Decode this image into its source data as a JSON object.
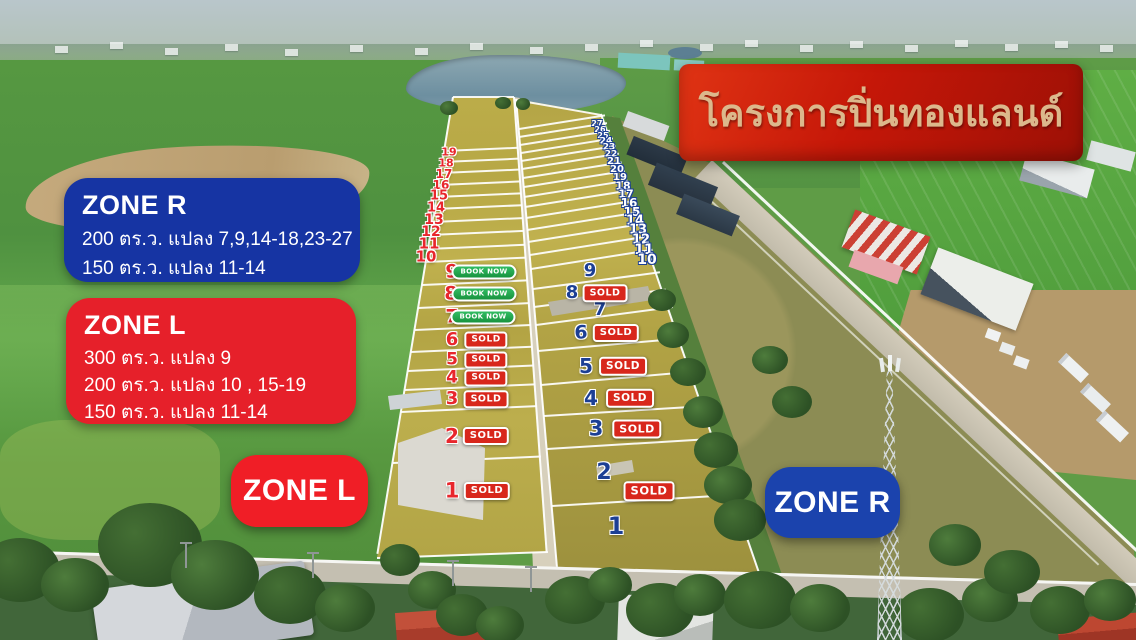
{
  "banner": {
    "title": "โครงการปิ่นทองแลนด์"
  },
  "info_boxes": {
    "zone_r": {
      "title": "ZONE R",
      "lines": [
        "200 ตร.ว. แปลง 7,9,14-18,23-27",
        "150 ตร.ว.  แปลง 11-14"
      ]
    },
    "zone_l": {
      "title": "ZONE L",
      "lines": [
        "300 ตร.ว. แปลง 9",
        "200 ตร.ว. แปลง 10 , 15-19",
        "150 ตร.ว.  แปลง 11-14"
      ]
    }
  },
  "buttons": {
    "zone_l": "ZONE L",
    "zone_r": "ZONE R"
  },
  "badges": {
    "sold": "SOLD",
    "book_now": "BOOK NOW"
  },
  "colors": {
    "banner_red": "#c21a0c",
    "banner_gold_text": "#dcb88c",
    "zone_blue": "#1634a3",
    "zone_red": "#e8212b",
    "sold_red": "#d8271c",
    "book_green": "#1f9e47",
    "num_red": "#e8262c",
    "num_navy": "#1c3f94"
  },
  "zone_l_strip": {
    "edge_numbers": [
      {
        "n": "19",
        "x": 449,
        "y": 152,
        "s": 11
      },
      {
        "n": "18",
        "x": 446,
        "y": 163,
        "s": 11
      },
      {
        "n": "17",
        "x": 444,
        "y": 174,
        "s": 12
      },
      {
        "n": "16",
        "x": 441,
        "y": 185,
        "s": 12
      },
      {
        "n": "15",
        "x": 439,
        "y": 196,
        "s": 13
      },
      {
        "n": "14",
        "x": 436,
        "y": 208,
        "s": 13
      },
      {
        "n": "13",
        "x": 434,
        "y": 220,
        "s": 14
      },
      {
        "n": "12",
        "x": 431,
        "y": 232,
        "s": 14
      },
      {
        "n": "11",
        "x": 429,
        "y": 244,
        "s": 15
      },
      {
        "n": "10",
        "x": 426,
        "y": 257,
        "s": 15
      }
    ],
    "plots": [
      {
        "n": "9",
        "x": 452,
        "y": 272,
        "s": 19,
        "badge": "book",
        "bx": 484,
        "bs": 7
      },
      {
        "n": "8",
        "x": 451,
        "y": 294,
        "s": 19,
        "badge": "book",
        "bx": 484,
        "bs": 7
      },
      {
        "n": "7",
        "x": 452,
        "y": 317,
        "s": 19,
        "badge": "book",
        "bx": 483,
        "bs": 7
      },
      {
        "n": "6",
        "x": 452,
        "y": 340,
        "s": 18,
        "badge": "sold",
        "bx": 486,
        "bs": 9
      },
      {
        "n": "5",
        "x": 452,
        "y": 360,
        "s": 17,
        "badge": "sold",
        "bx": 486,
        "bs": 9
      },
      {
        "n": "4",
        "x": 452,
        "y": 378,
        "s": 17,
        "badge": "sold",
        "bx": 486,
        "bs": 9
      },
      {
        "n": "3",
        "x": 452,
        "y": 399,
        "s": 18,
        "badge": "sold",
        "bx": 486,
        "bs": 9.5
      },
      {
        "n": "2",
        "x": 452,
        "y": 436,
        "s": 20,
        "badge": "sold",
        "bx": 486,
        "bs": 10
      },
      {
        "n": "1",
        "x": 452,
        "y": 491,
        "s": 21,
        "badge": "sold",
        "bx": 487,
        "bs": 10
      }
    ]
  },
  "zone_r_strip": {
    "edge_numbers": [
      {
        "n": "27",
        "x": 597,
        "y": 124,
        "s": 8
      },
      {
        "n": "26",
        "x": 600,
        "y": 130,
        "s": 8
      },
      {
        "n": "25",
        "x": 603,
        "y": 136,
        "s": 8
      },
      {
        "n": "24",
        "x": 606,
        "y": 142,
        "s": 9
      },
      {
        "n": "23",
        "x": 609,
        "y": 148,
        "s": 9
      },
      {
        "n": "22",
        "x": 611,
        "y": 155,
        "s": 9
      },
      {
        "n": "21",
        "x": 614,
        "y": 162,
        "s": 10
      },
      {
        "n": "20",
        "x": 617,
        "y": 170,
        "s": 10
      },
      {
        "n": "19",
        "x": 620,
        "y": 178,
        "s": 10
      },
      {
        "n": "18",
        "x": 623,
        "y": 186,
        "s": 11
      },
      {
        "n": "17",
        "x": 626,
        "y": 194,
        "s": 11
      },
      {
        "n": "16",
        "x": 629,
        "y": 203,
        "s": 12
      },
      {
        "n": "15",
        "x": 632,
        "y": 212,
        "s": 12
      },
      {
        "n": "14",
        "x": 635,
        "y": 221,
        "s": 13
      },
      {
        "n": "13",
        "x": 638,
        "y": 230,
        "s": 13
      },
      {
        "n": "12",
        "x": 641,
        "y": 240,
        "s": 13
      },
      {
        "n": "11",
        "x": 644,
        "y": 250,
        "s": 14
      },
      {
        "n": "10",
        "x": 647,
        "y": 260,
        "s": 14
      }
    ],
    "plots": [
      {
        "n": "9",
        "x": 590,
        "y": 271,
        "s": 18
      },
      {
        "n": "8",
        "x": 572,
        "y": 293,
        "s": 18,
        "badge": "sold",
        "bx": 605,
        "bs": 9.5
      },
      {
        "n": "7",
        "x": 600,
        "y": 310,
        "s": 18
      },
      {
        "n": "6",
        "x": 581,
        "y": 333,
        "s": 19,
        "badge": "sold",
        "bx": 616,
        "bs": 10
      },
      {
        "n": "5",
        "x": 586,
        "y": 366,
        "s": 20,
        "badge": "sold",
        "bx": 623,
        "bs": 10.5
      },
      {
        "n": "4",
        "x": 591,
        "y": 398,
        "s": 20,
        "badge": "sold",
        "bx": 630,
        "bs": 10.5
      },
      {
        "n": "3",
        "x": 596,
        "y": 429,
        "s": 21,
        "badge": "sold",
        "bx": 637,
        "bs": 11
      },
      {
        "n": "2",
        "x": 604,
        "y": 473,
        "s": 22
      },
      {
        "n": "1",
        "x": 616,
        "y": 526,
        "s": 24
      }
    ],
    "floating_badges": [
      {
        "label": "sold",
        "x": 649,
        "y": 491,
        "bs": 11.5
      }
    ]
  }
}
